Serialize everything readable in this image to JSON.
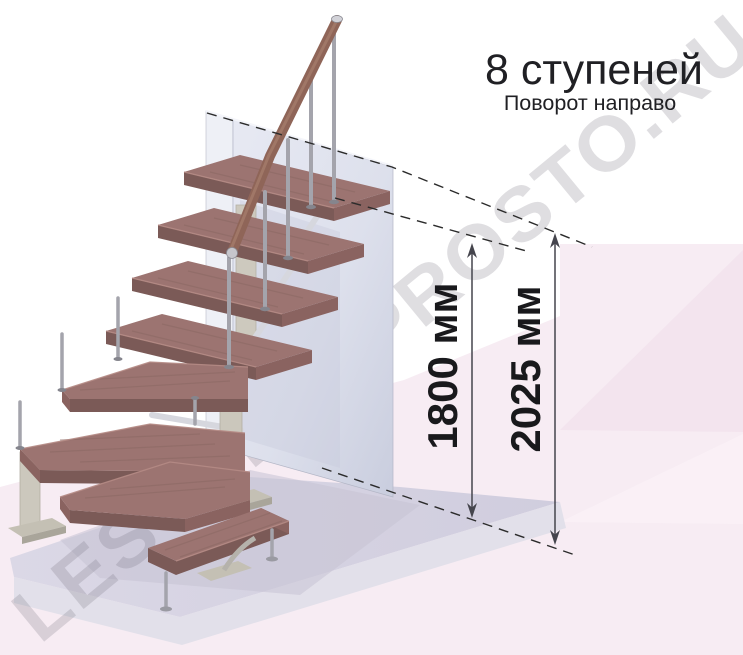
{
  "header": {
    "title": "8 ступеней",
    "subtitle": "Поворот направо"
  },
  "dimensions": {
    "inner": "1800 мм",
    "outer": "2025 мм"
  },
  "watermark": {
    "text": "LESTNICY-PROSTO.RU"
  },
  "scene": {
    "steps_shown": 8,
    "turn_direction": "направо"
  },
  "colors": {
    "wood_top": "#9c7471",
    "wood_front": "#7b5a57",
    "wood_end": "#8a6360",
    "handrail": "#8f6558",
    "metal": "#a4a4ac",
    "support_beige": "#cbc7bc",
    "wall": "#dfe2ee",
    "wall_side": "#eef0f6",
    "floor_top": "#d5d2e2",
    "floor_front": "#e2e0ea",
    "background_pink": "#f7ecf3",
    "text": "#202024",
    "dimension_line": "#45454d"
  }
}
